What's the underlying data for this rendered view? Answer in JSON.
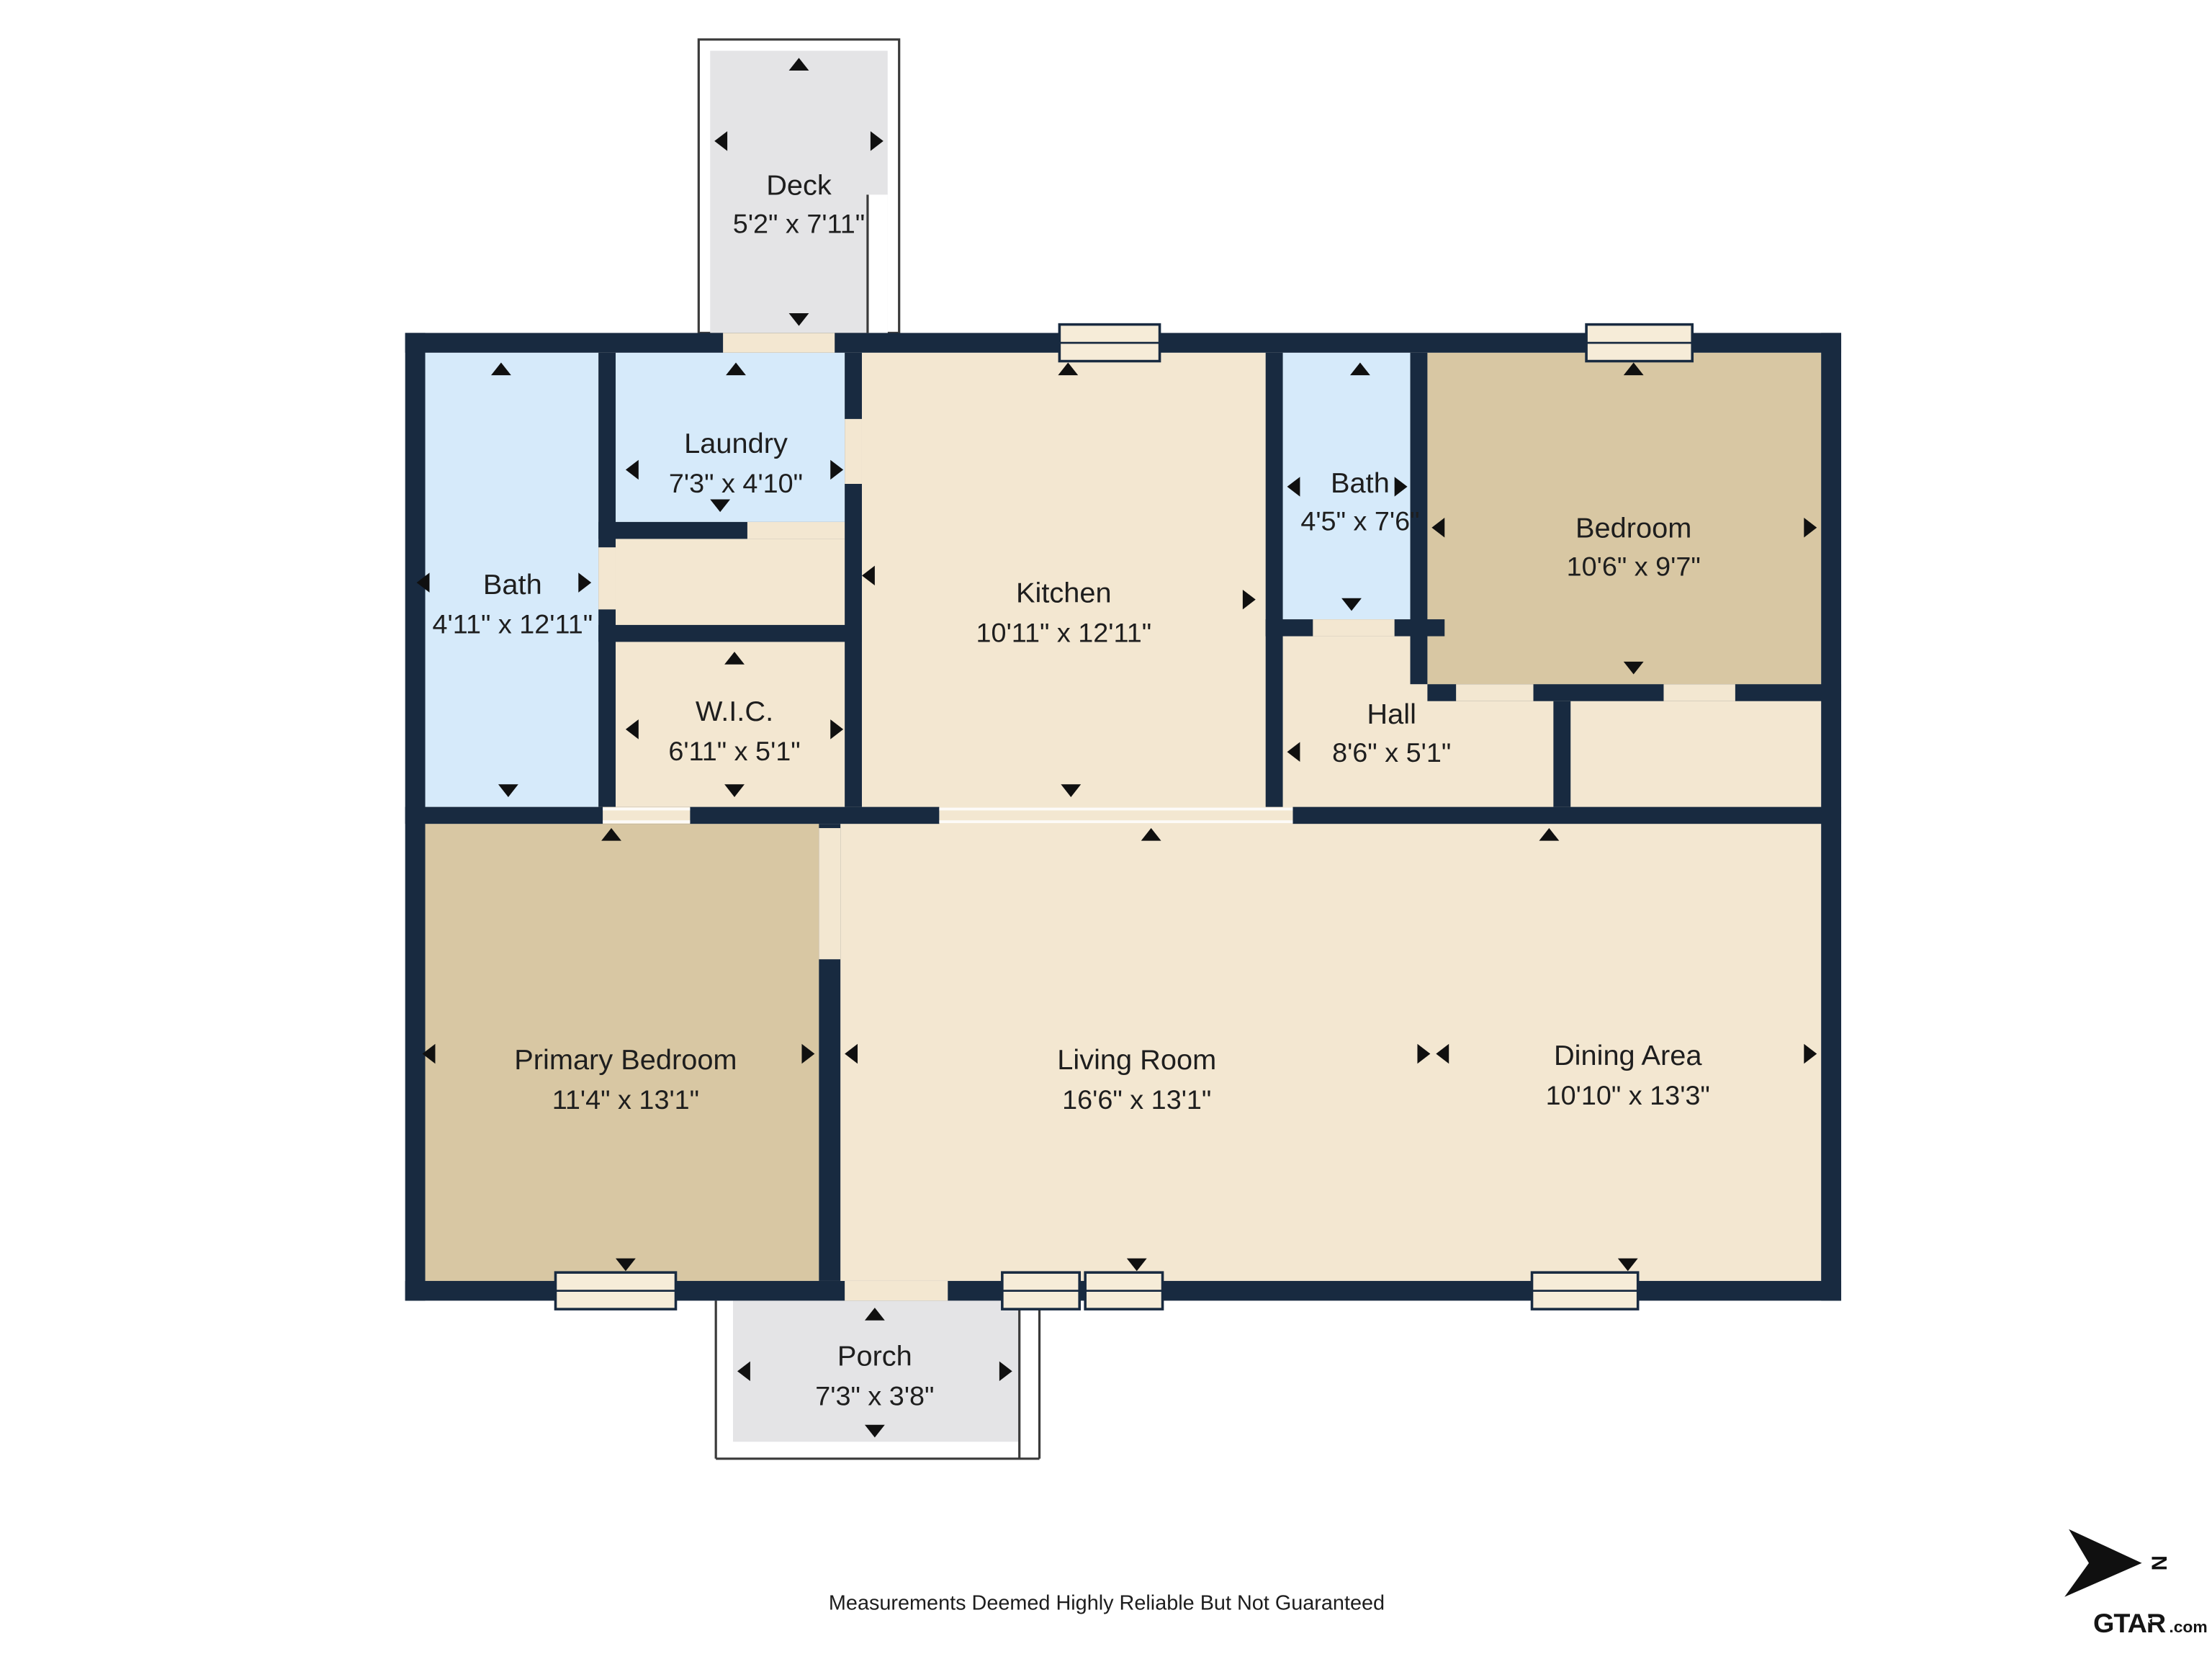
{
  "rooms": {
    "deck": {
      "name": "Deck",
      "dims": "5'2\" x 7'11\""
    },
    "bath1": {
      "name": "Bath",
      "dims": "4'11\" x 12'11\""
    },
    "laundry": {
      "name": "Laundry",
      "dims": "7'3\" x 4'10\""
    },
    "kitchen": {
      "name": "Kitchen",
      "dims": "10'11\" x 12'11\""
    },
    "bath2": {
      "name": "Bath",
      "dims": "4'5\" x 7'6\""
    },
    "bedroom": {
      "name": "Bedroom",
      "dims": "10'6\" x 9'7\""
    },
    "wic": {
      "name": "W.I.C.",
      "dims": "6'11\" x 5'1\""
    },
    "hall": {
      "name": "Hall",
      "dims": "8'6\" x 5'1\""
    },
    "primary": {
      "name": "Primary Bedroom",
      "dims": "11'4\" x 13'1\""
    },
    "living": {
      "name": "Living Room",
      "dims": "16'6\" x 13'1\""
    },
    "dining": {
      "name": "Dining Area",
      "dims": "10'10\" x 13'3\""
    },
    "porch": {
      "name": "Porch",
      "dims": "7'3\" x 3'8\""
    }
  },
  "footer": {
    "disclaimer": "Measurements Deemed Highly Reliable But Not Guaranteed"
  },
  "compass": {
    "label": "N"
  },
  "logo": {
    "brand": "GTAR",
    "suffix": ".com"
  },
  "colors": {
    "wall": "#182A40",
    "floor_main": "#F3E7D1",
    "floor_bath": "#D6EAFA",
    "floor_bedroom": "#D8C7A3",
    "floor_outdoor": "#E4E4E6",
    "window_fill": "#F6ECD8"
  }
}
